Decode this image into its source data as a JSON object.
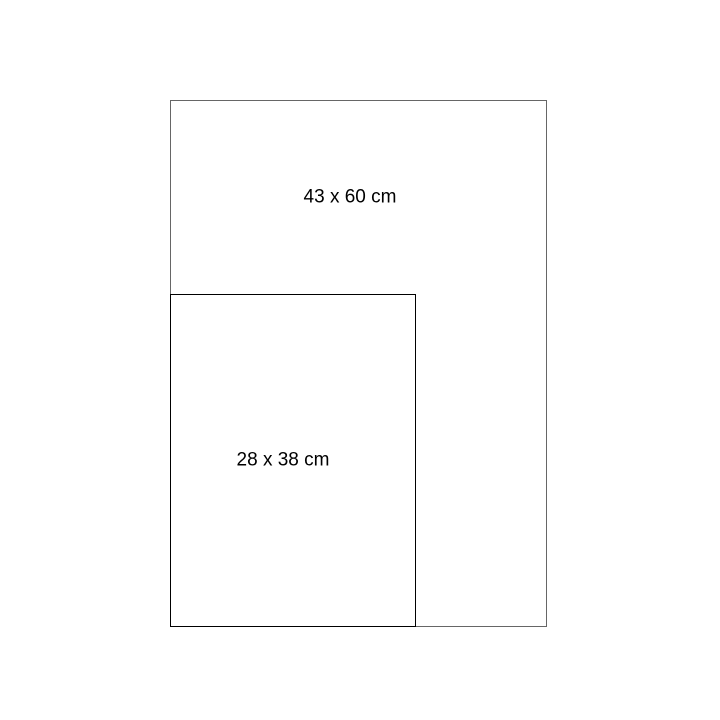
{
  "diagram": {
    "background_color": "#ffffff",
    "rectangles": [
      {
        "id": "outer",
        "label": "43 x 60 cm",
        "width_cm": 43,
        "height_cm": 60,
        "stroke_color": "#666666"
      },
      {
        "id": "inner",
        "label": "28 x 38 cm",
        "width_cm": 28,
        "height_cm": 38,
        "stroke_color": "#000000"
      }
    ]
  }
}
